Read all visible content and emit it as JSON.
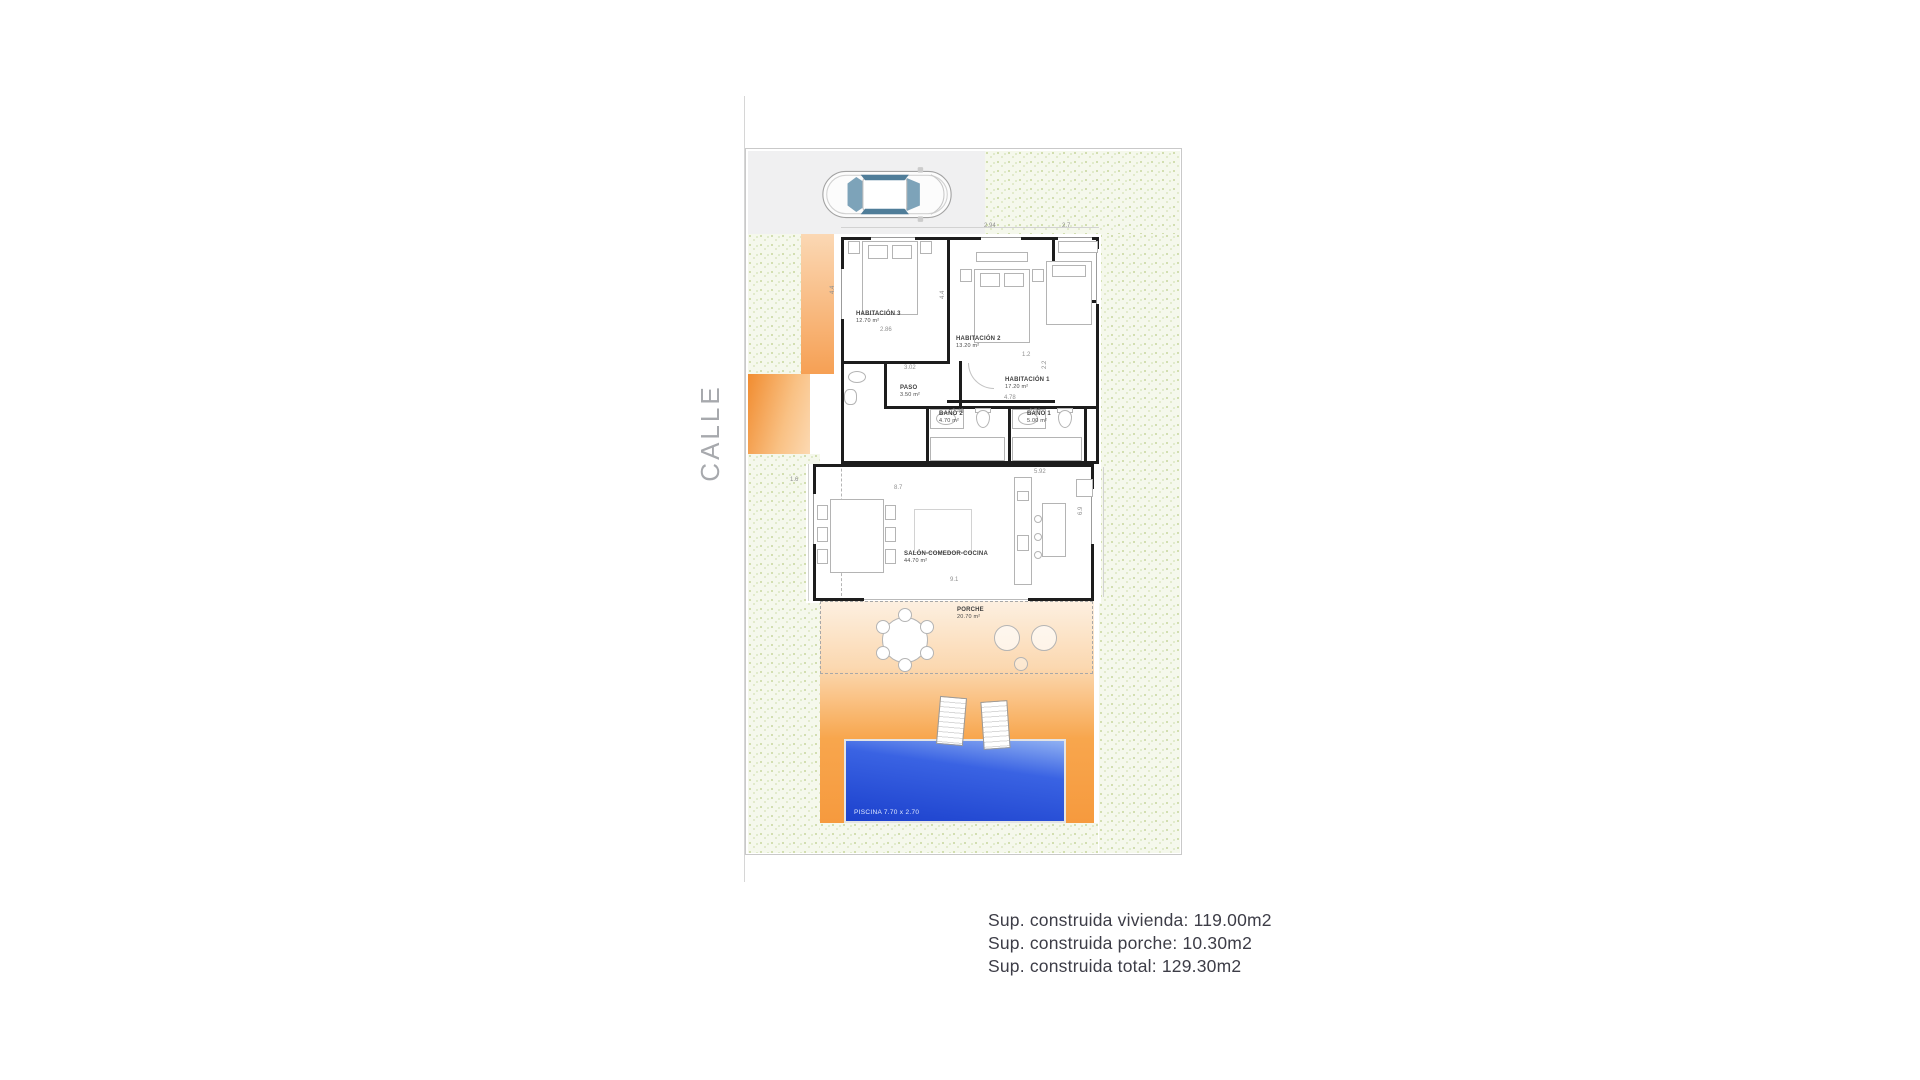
{
  "street": {
    "label": "CALLE"
  },
  "rooms": [
    {
      "id": "habitacion-3",
      "name": "HABITACIÓN 3",
      "area": "12.70 m²",
      "x": 110,
      "y": 162
    },
    {
      "id": "habitacion-2",
      "name": "HABITACIÓN 2",
      "area": "13.20 m²",
      "x": 210,
      "y": 187
    },
    {
      "id": "habitacion-1",
      "name": "HABITACIÓN 1",
      "area": "17.20 m²",
      "x": 259,
      "y": 228
    },
    {
      "id": "paso",
      "name": "PASO",
      "area": "3.50 m²",
      "x": 154,
      "y": 236
    },
    {
      "id": "bano-2",
      "name": "BAÑO 2",
      "area": "4.70 m²",
      "x": 193,
      "y": 262
    },
    {
      "id": "bano-1",
      "name": "BAÑO 1",
      "area": "5.00 m²",
      "x": 281,
      "y": 262
    },
    {
      "id": "salon",
      "name": "SALÓN-COMEDOR-COCINA",
      "area": "44.70 m²",
      "x": 158,
      "y": 402
    },
    {
      "id": "porche",
      "name": "PORCHE",
      "area": "20.70 m²",
      "x": 211,
      "y": 458
    }
  ],
  "pool": {
    "label": "PISCINA 7.70 x 2.70"
  },
  "dimensions": [
    {
      "text": "2.94",
      "x": 238,
      "y": 74
    },
    {
      "text": "2.7",
      "x": 316,
      "y": 74
    },
    {
      "text": "4.4",
      "x": 84,
      "y": 145,
      "v": true
    },
    {
      "text": "4.4",
      "x": 194,
      "y": 150,
      "v": true
    },
    {
      "text": "2.86",
      "x": 134,
      "y": 178
    },
    {
      "text": "3.02",
      "x": 158,
      "y": 216
    },
    {
      "text": "1.2",
      "x": 276,
      "y": 203
    },
    {
      "text": "2.2",
      "x": 296,
      "y": 220,
      "v": true
    },
    {
      "text": "4.78",
      "x": 258,
      "y": 246
    },
    {
      "text": "2.46",
      "x": 206,
      "y": 260
    },
    {
      "text": "2.70",
      "x": 283,
      "y": 260
    },
    {
      "text": "1.6",
      "x": 44,
      "y": 328
    },
    {
      "text": "5.92",
      "x": 288,
      "y": 320
    },
    {
      "text": "8.7",
      "x": 148,
      "y": 336
    },
    {
      "text": "6.9",
      "x": 332,
      "y": 366,
      "v": true
    },
    {
      "text": "9.1",
      "x": 204,
      "y": 428
    }
  ],
  "summary": {
    "lines": [
      "Sup. construida vivienda: 119.00m2",
      "Sup. construida porche: 10.30m2",
      "Sup. construida total: 129.30m2"
    ]
  },
  "colors": {
    "accent_orange": "#f79b44",
    "pool_blue": "#1f48d4",
    "grass_green": "#cfdfae",
    "wall_black": "#1d1d1d",
    "driveway_gray": "#f0f0f1"
  }
}
